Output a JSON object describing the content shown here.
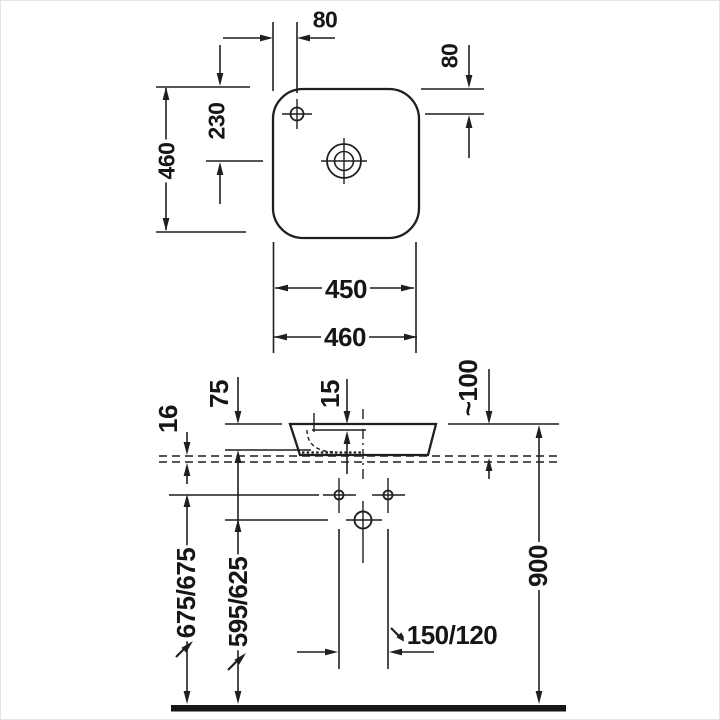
{
  "drawing_type": "washbasin technical dimension drawing",
  "labels": {
    "plan": {
      "faucet_offset_x": "80",
      "faucet_offset_y": "80",
      "depth_overall": "460",
      "faucet_to_drain": "230",
      "width_inner": "450",
      "width_overall": "460"
    },
    "elevation": {
      "bowl_depth": "75",
      "rim_to_inner_edge": "15",
      "counter_thickness": "16",
      "height_above_counter": "~100",
      "outlet_height_a": "675/675",
      "outlet_height_b": "595/625",
      "supply_spacing": "150/120",
      "rim_height": "900"
    }
  }
}
